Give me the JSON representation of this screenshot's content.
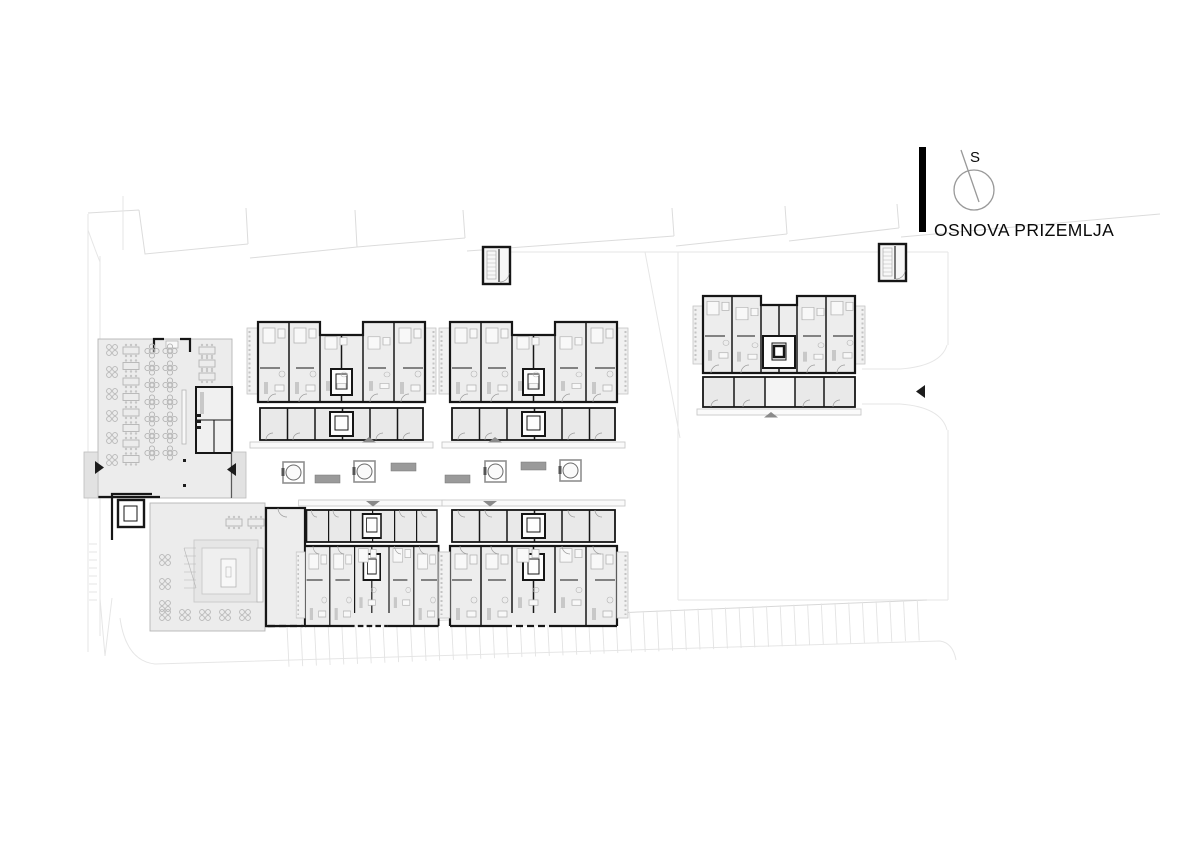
{
  "title_block": {
    "title": "OSNOVA PRIZEMLJA",
    "compass_label": "S"
  },
  "palette": {
    "wall": "#161616",
    "room_fill": "#ededed",
    "storage_fill": "#e9e9e9",
    "balcony_fill": "#f1f1f1",
    "furniture_line": "#b4b4b4",
    "site_line": "#dcdcdc",
    "canopy_marker": "#8a8a8a",
    "bench": "#9a9a9a",
    "entrance_arrow": "#1c1c1c"
  },
  "site_furniture": {
    "tree_planters": [
      {
        "x": 283,
        "y": 462
      },
      {
        "x": 354,
        "y": 461
      },
      {
        "x": 485,
        "y": 461
      },
      {
        "x": 560,
        "y": 460
      }
    ],
    "benches": [
      {
        "x": 315,
        "y": 475
      },
      {
        "x": 391,
        "y": 463
      },
      {
        "x": 445,
        "y": 475
      },
      {
        "x": 521,
        "y": 462
      }
    ],
    "entrance_arrows": [
      {
        "x": 95,
        "y": 461,
        "dir": "right"
      },
      {
        "x": 227,
        "y": 463,
        "dir": "left"
      },
      {
        "x": 916,
        "y": 385,
        "dir": "left"
      }
    ],
    "canopy_markers": [
      {
        "x": 362,
        "y": 437,
        "dir": "up"
      },
      {
        "x": 488,
        "y": 437,
        "dir": "up"
      },
      {
        "x": 366,
        "y": 501,
        "dir": "down"
      },
      {
        "x": 483,
        "y": 501,
        "dir": "down"
      },
      {
        "x": 764,
        "y": 412,
        "dir": "up"
      }
    ]
  },
  "parking": {
    "stall_count": 47
  }
}
